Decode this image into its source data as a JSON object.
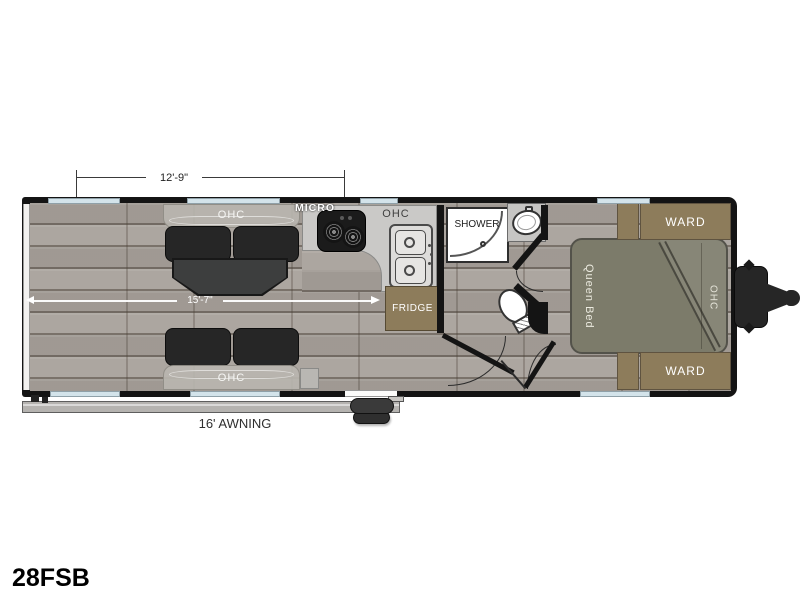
{
  "model_label": "28FSB",
  "dimensions": {
    "garage_length": "12'-9\"",
    "interior_length": "15'-7\""
  },
  "awning": {
    "label": "16' AWNING"
  },
  "labels": {
    "ohc_sofa_top": "OHC",
    "ohc_sofa_bottom": "OHC",
    "ohc_kitchen": "OHC",
    "ohc_bed": "OHC",
    "micro": "MICRO",
    "shower": "SHOWER",
    "fridge": "FRIDGE",
    "ward_top": "WARD",
    "ward_bottom": "WARD",
    "queen_bed": "Queen Bed"
  },
  "colors": {
    "wall": "#141414",
    "floor": "#a8a19b",
    "window": "#d3e3ea",
    "cabinet": "#8d7c5b",
    "bed": "#7c7b6a",
    "counter": "#cac9c7",
    "sofa": "#262626",
    "table": "#3d3e3e"
  }
}
